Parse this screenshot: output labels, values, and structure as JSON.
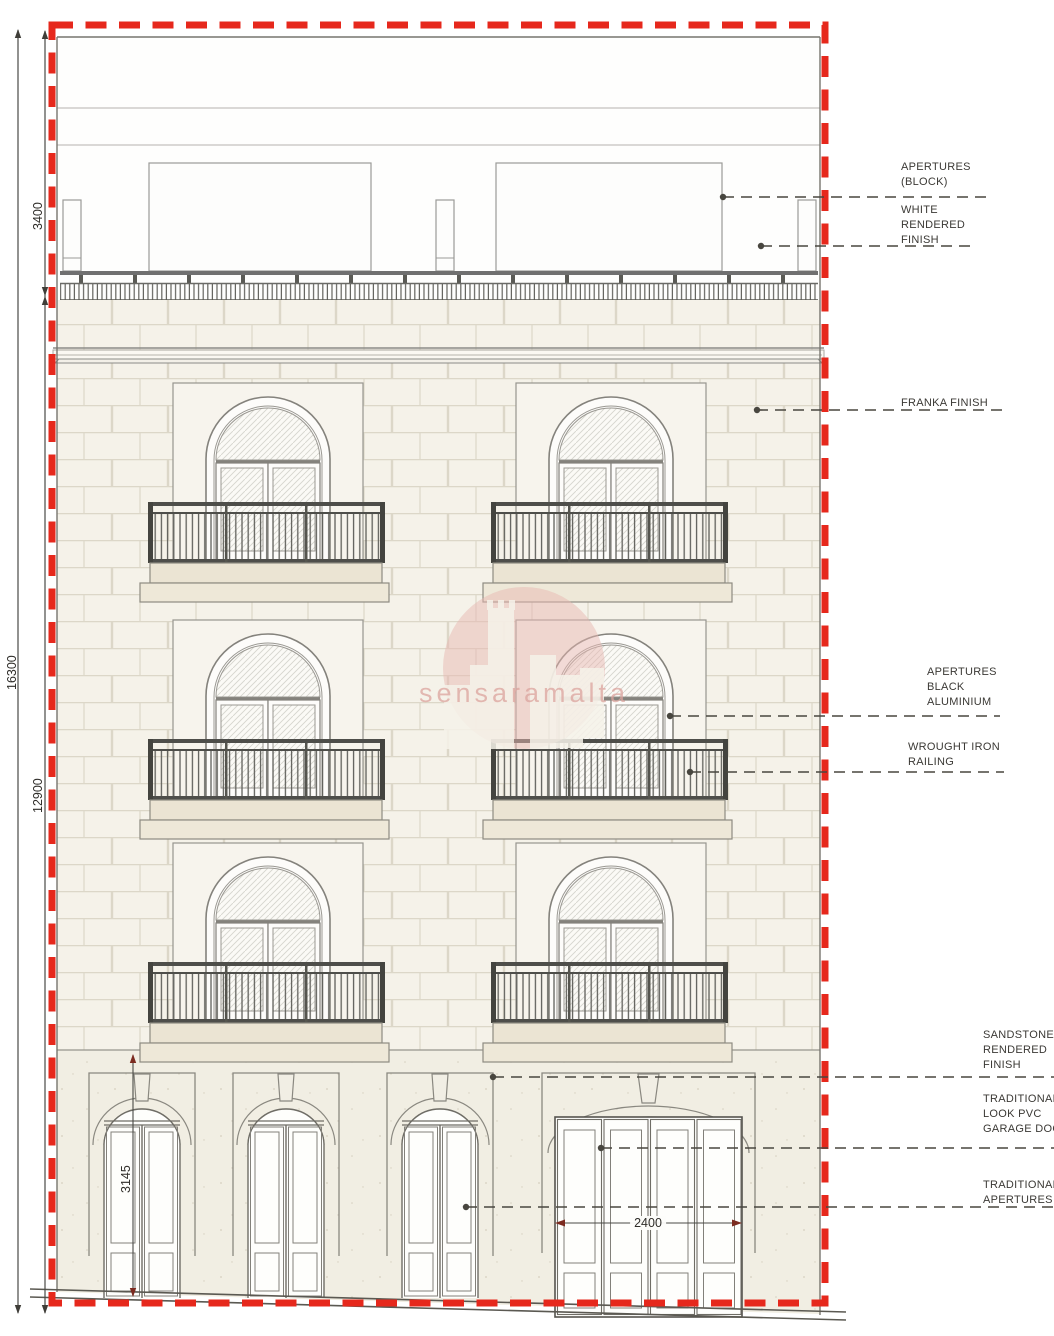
{
  "watermark": {
    "text": "sensaramalta"
  },
  "dimensions": {
    "overall_height": "16300",
    "roof_level_height": "3400",
    "facade_height": "12900",
    "door_height": "3145",
    "garage_width": "2400"
  },
  "annotations": {
    "apertures_block": {
      "lines": [
        "APERTURES",
        "(BLOCK)"
      ]
    },
    "white_rendered_finish": {
      "lines": [
        "WHITE",
        "RENDERED",
        "FINISH"
      ]
    },
    "franka_finish": {
      "lines": [
        "FRANKA FINISH"
      ]
    },
    "apertures_black_aluminium": {
      "lines": [
        "APERTURES",
        "BLACK",
        "ALUMINIUM"
      ]
    },
    "wrought_iron_railing": {
      "lines": [
        "WROUGHT IRON",
        "RAILING"
      ]
    },
    "sandstone_rendered_finish": {
      "lines": [
        "SANDSTONE",
        "RENDERED",
        "FINISH"
      ]
    },
    "traditional_pvc_garage_door": {
      "lines": [
        "TRADITIONAL",
        "LOOK PVC",
        "GARAGE  DOOR"
      ]
    },
    "traditional_apertures": {
      "lines": [
        "TRADITIONAL",
        "APERTURES"
      ]
    }
  },
  "colors": {
    "boundary_red": "#e6281c",
    "wall_cream": "#f5f2e9",
    "ground_render": "#f1eee3",
    "slab_beige": "#ebe4d3",
    "railing_dark": "#4a4a46",
    "watermark_pink": "#e8b7b2"
  }
}
